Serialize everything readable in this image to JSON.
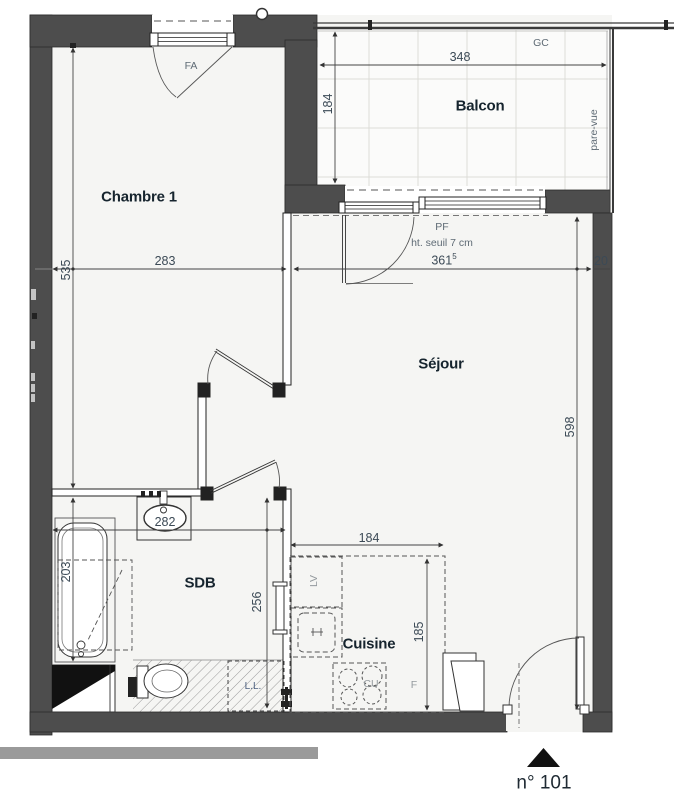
{
  "unit_label": "n° 101",
  "rooms": {
    "bedroom": "Chambre 1",
    "balcony": "Balcon",
    "living": "Séjour",
    "bathroom": "SDB",
    "kitchen": "Cuisine"
  },
  "annotations": {
    "front_window": "FA",
    "gc": "GC",
    "privacy_screen": "pare-vue",
    "french_window": "PF",
    "threshold": "ht. seuil 7 cm",
    "dishwasher": "LV",
    "cooktop": "CU",
    "fridge": "F",
    "washing_machine": "L.L."
  },
  "dimensions": {
    "balcony_width": "348",
    "balcony_depth": "184",
    "bedroom_width": "283",
    "bedroom_length": "535",
    "living_width": "361",
    "living_width_sup": "5",
    "wall_thickness": "20",
    "living_length": "598",
    "bathroom_width": "282",
    "bathtub_length": "203",
    "bathroom_length": "256",
    "kitchen_width": "184",
    "kitchen_depth": "185"
  },
  "colors": {
    "wall": "#4d4d4d",
    "floor": "#f5f5f3",
    "balcony_floor": "#fbfbfa",
    "grid_line": "#dcdcd8",
    "dimension_text": "#3c4a56",
    "label_text": "#16242e",
    "annotation_text": "#5f6b75"
  }
}
